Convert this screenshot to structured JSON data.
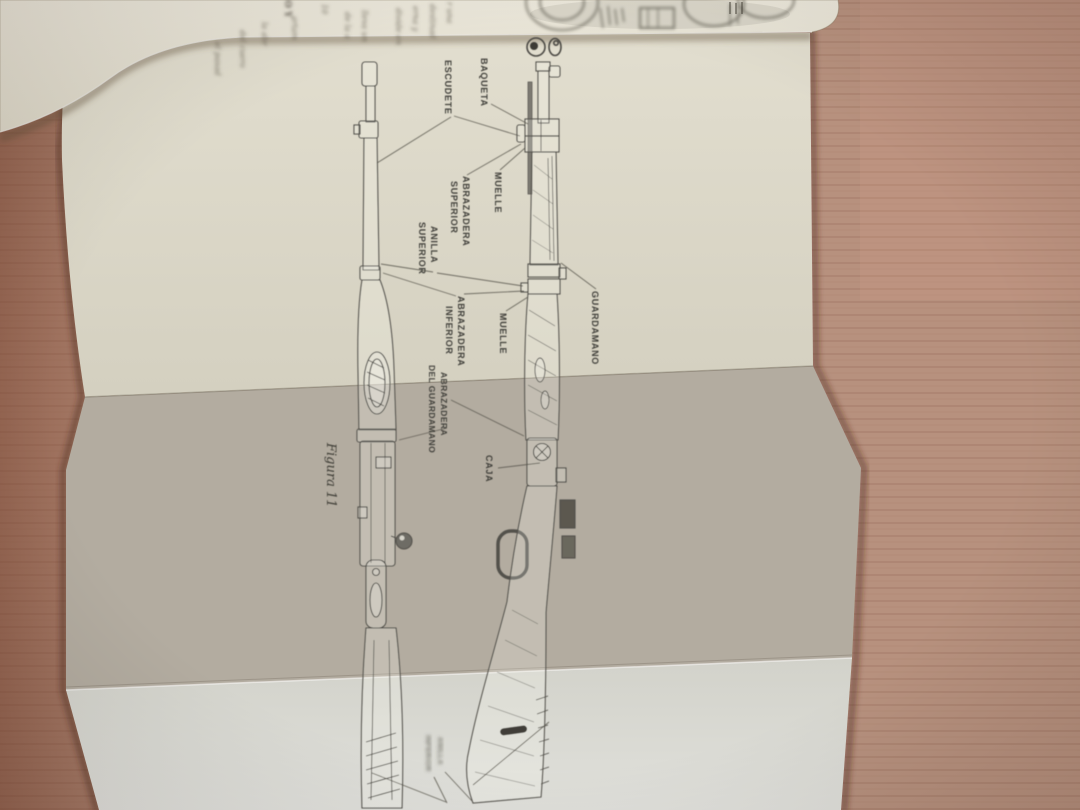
{
  "diagram": {
    "caption": "Figura 11",
    "labels": {
      "baqueta": {
        "lines": [
          "BAQUETA"
        ]
      },
      "escudete": {
        "lines": [
          "ESCUDETE"
        ]
      },
      "muelle_top": {
        "lines": [
          "MUELLE"
        ]
      },
      "abrazadera_superior": {
        "lines": [
          "ABRAZADERA",
          "SUPERIOR"
        ]
      },
      "anilla_superior": {
        "lines": [
          "ANILLA",
          "SUPERIOR"
        ]
      },
      "abrazadera_inferior": {
        "lines": [
          "ABRAZADERA",
          "INFERIOR"
        ]
      },
      "muelle_mid": {
        "lines": [
          "MUELLE"
        ]
      },
      "guardamano": {
        "lines": [
          "GUARDAMANO"
        ]
      },
      "abrazadera_del_guardamano": {
        "lines": [
          "ABRAZADERA",
          "DEL GUARDAMANO"
        ]
      },
      "caja": {
        "lines": [
          "CAJA"
        ]
      },
      "anilla_inferior": {
        "lines": [
          "ANILLA",
          "INFERIOR"
        ]
      }
    }
  },
  "peek_page": {
    "page_number": "10",
    "header_fragment": "O Y",
    "text_fragments": [
      "r una",
      "destinad",
      "erna y",
      "divide en",
      "lleva un",
      "de la a",
      "artam",
      "la abr",
      "del cuero",
      "el pasad"
    ]
  },
  "colors": {
    "wood": "#b7917e",
    "wood_dark": "#9c6a52",
    "page_top": "#dad6c7",
    "page_middle": "#b3aca0",
    "page_bottom": "#d8d8d1",
    "peek_page": "#e9e5d8",
    "ink": "#4a4842"
  }
}
